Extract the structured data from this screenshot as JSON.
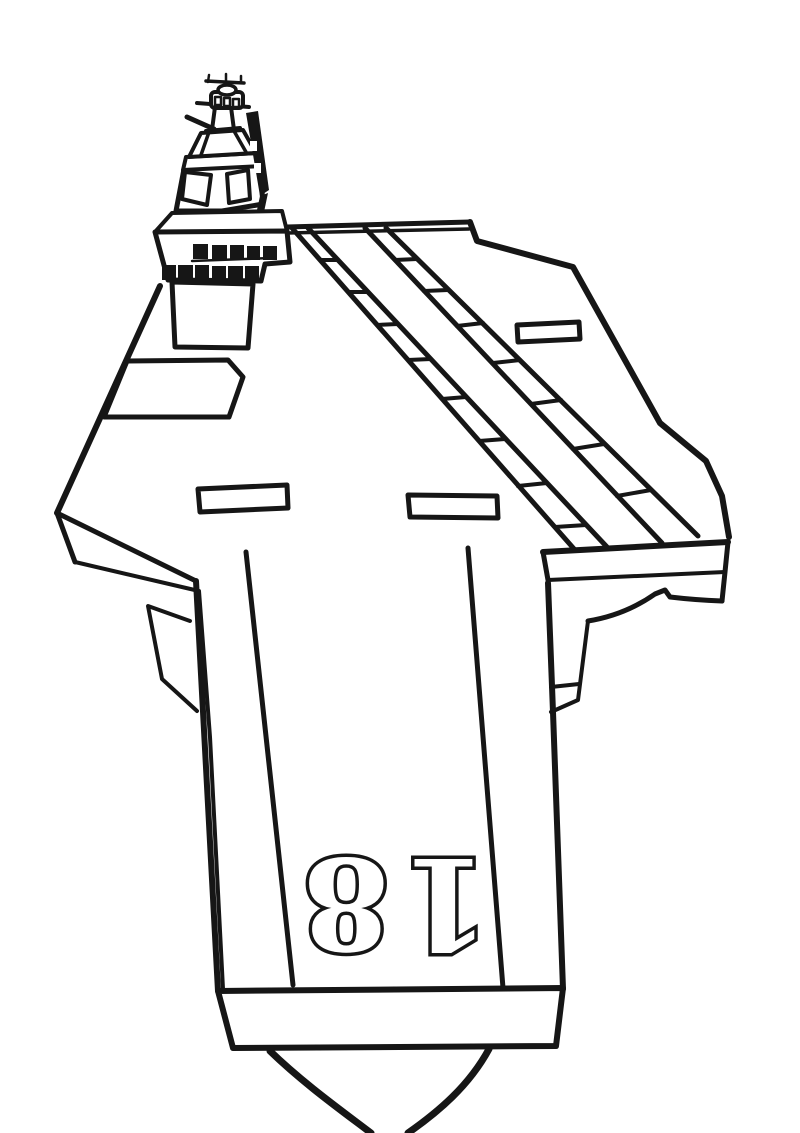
{
  "art": {
    "subject": "aircraft carrier flight deck, top view, black outline line drawing",
    "ink": "#161616",
    "paper": "#ffffff",
    "deck": {
      "hull_number": "18",
      "hull_number_rotation_deg": 180
    },
    "island": {
      "window_rows_top_count": 5,
      "window_rows_bottom_count": 6
    },
    "markings": {
      "angled_deck_stripe_count": 2,
      "catapult_line_count": 2,
      "elevator_rectangle_count": 3,
      "bow_panel_count": 1
    }
  }
}
